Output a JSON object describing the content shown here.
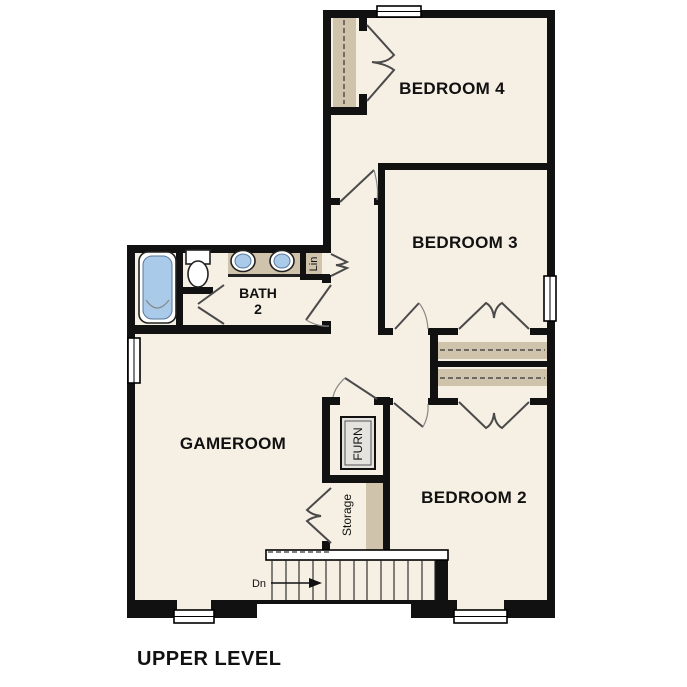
{
  "title": "UPPER LEVEL",
  "rooms": {
    "bedroom4": "BEDROOM 4",
    "bedroom3": "BEDROOM 3",
    "bedroom2": "BEDROOM 2",
    "gameroom": "GAMEROOM",
    "bath": {
      "line1": "BATH",
      "line2": "2"
    }
  },
  "closets": {
    "linen": "Lin",
    "furnace": "FURN",
    "storage": "Storage"
  },
  "stairs": {
    "direction_label": "Dn"
  },
  "colors": {
    "bg": "#ffffff",
    "floor": "#f6efe4",
    "wall": "#111111",
    "tan": "#cfc3ac",
    "blue": "#a9cbe9",
    "furn": "#e4e3de"
  }
}
